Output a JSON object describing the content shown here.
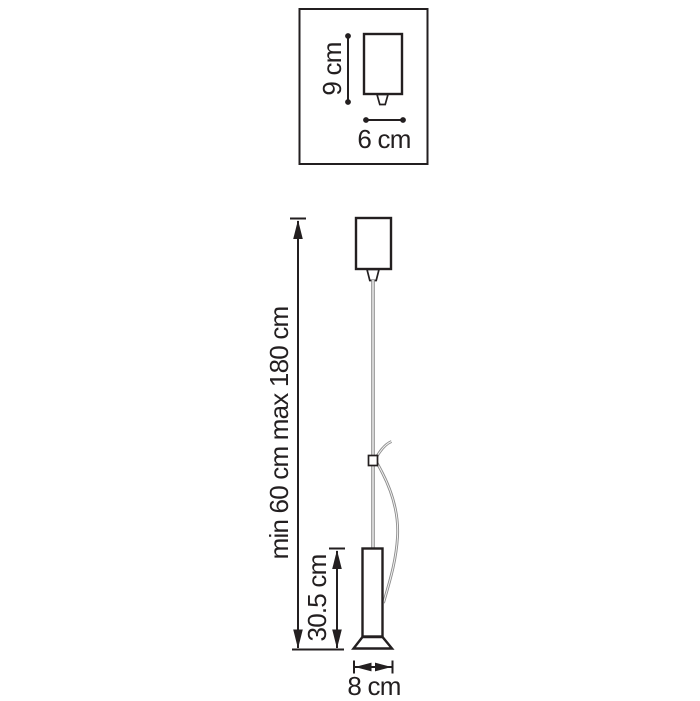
{
  "diagram_type": "pendant-lamp-dimension-drawing",
  "colors": {
    "line": "#231f20",
    "cable": "#8c8c8c",
    "background": "#ffffff"
  },
  "inset": {
    "height_label": "9 cm",
    "width_label": "6 cm"
  },
  "main": {
    "suspension_range_label": "min 60 cm max 180 cm",
    "body_height_label": "30.5 cm",
    "base_width_label": "8 cm"
  }
}
